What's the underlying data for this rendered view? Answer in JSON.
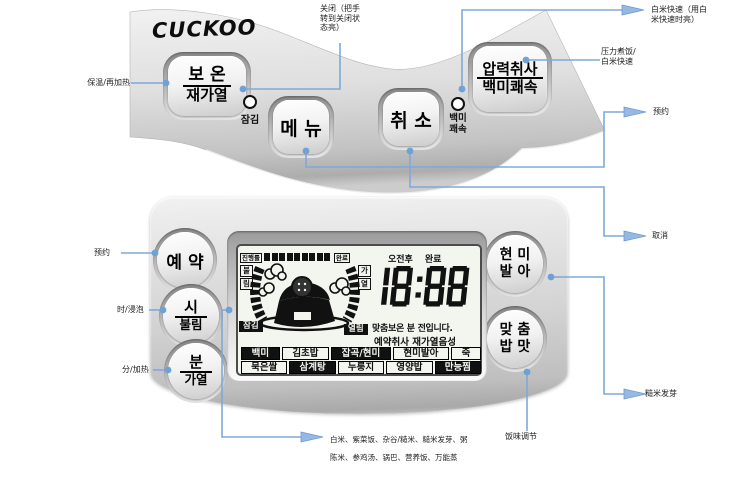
{
  "brand": {
    "logo": "CUCKOO"
  },
  "colors": {
    "line_blue": "#7fa8d9",
    "arrow_blue": "#96b9e4",
    "dot_blue": "#6fa0d6",
    "panel_silver": "#d3d3d3",
    "lcd_bg": "#f3f5ef",
    "text_black": "#111111"
  },
  "top_panel": {
    "buttons": {
      "keep_warm": {
        "line1": "보 온",
        "line2": "재가열"
      },
      "menu": "메 뉴",
      "cancel": "취 소",
      "pressure_cook": {
        "line1": "압력취사",
        "line2": "백미쾌속"
      }
    },
    "indicators": {
      "lock_label": "잠김",
      "white_rice_quick_label": "백미\n쾌속"
    }
  },
  "lower_panel": {
    "buttons": {
      "preset": "예 약",
      "hour_soak": {
        "line1": "시",
        "line2": "불림"
      },
      "minute_heat": {
        "line1": "분",
        "line2": "가열"
      },
      "brown_rice_germination": "현 미\n발 아",
      "custom_taste": "맞 춤\n밥 맛"
    }
  },
  "lcd": {
    "progress_label": "진행률",
    "progress_segments": 9,
    "complete_label": "완료",
    "soak_label": "불림",
    "heat_label": "가열",
    "lock_tag": "잠김",
    "open_tag": "열림",
    "ampm": "오전후",
    "done": "완료",
    "clock": "18:88",
    "message1": "맞춤보온 분 전입니다.",
    "message2": "예약취사 재가열음성",
    "menu_row1": [
      {
        "label": "백미",
        "inverted": true
      },
      {
        "label": "김초밥",
        "inverted": false
      },
      {
        "label": "잡곡/현미",
        "inverted": true
      },
      {
        "label": "현미발아",
        "inverted": false
      },
      {
        "label": "죽",
        "inverted": false
      }
    ],
    "menu_row2": [
      {
        "label": "묵은쌀",
        "inverted": false
      },
      {
        "label": "삼계탕",
        "inverted": true
      },
      {
        "label": "누룽지",
        "inverted": false
      },
      {
        "label": "영양밥",
        "inverted": false
      },
      {
        "label": "만능찜",
        "inverted": true
      }
    ]
  },
  "annotations": {
    "keep_warm": "保温/再加热",
    "lock": "关闭（把手\n转到关闭状\n态亮）",
    "white_rice_quick": "白米快速（用白\n米快速时亮）",
    "pressure_cook": "压力煮饭/\n白米快速",
    "preset_right": "预约",
    "cancel": "取消",
    "germination": "糙米发芽",
    "taste_adjust": "饭味调节",
    "preset_left": "预约",
    "hour_soak": "时/浸泡",
    "minute_heat": "分/加热",
    "menu_items_line1": "白米、紫菜饭、杂谷/糙米、糙米发芽、粥",
    "menu_items_line2": "陈米、参鸡汤、锅巴、营养饭、万能蒸"
  }
}
